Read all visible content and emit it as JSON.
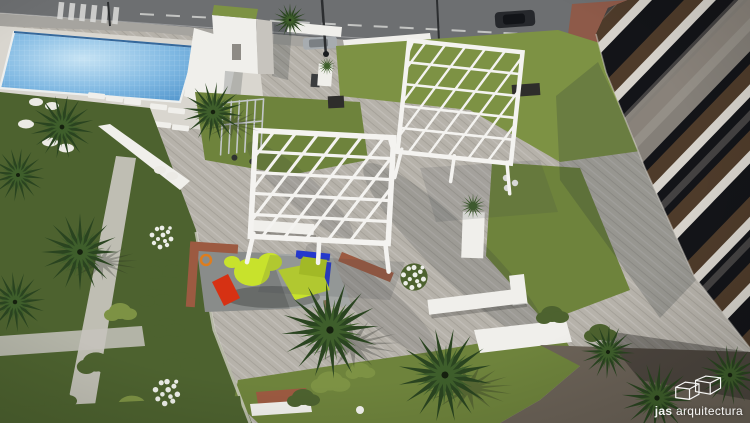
{
  "watermark": {
    "brand_bold": "jas",
    "brand_rest": " arquitectura",
    "logo_icon": "double-cube-wireframe-icon"
  },
  "palette": {
    "plaza_paving": "#b6b2aa",
    "street_asphalt": "#6d6f71",
    "sidewalk_grey": "#a6a49f",
    "structure_white": "#f0efeb",
    "deck_white": "#d9d6cf",
    "pergola_white": "#f4f3f0",
    "pool_light": "#c6e3f4",
    "pool_mid": "#7fb8e2",
    "pool_deep": "#4b90c9",
    "pool_edge": "#35689b",
    "lawn_green": "#6e833c",
    "lawn_bright": "#7d9244",
    "lawn_dark": "#4d622f",
    "palm_dark": "#2a4420",
    "palm_mid": "#3e5e2b",
    "brick_red": "#9c5a41",
    "building_slab": "#d6d2cb",
    "building_glass": "#131418",
    "building_wood": "#4e3b2a",
    "building_concrete": "#8e8981",
    "building_base": "#262019",
    "bike_lane_red": "#8e5a49",
    "play_surface": "#a4a7a5",
    "play_yellow": "#c8e22c",
    "play_blue": "#2438cd",
    "play_red": "#d63113",
    "play_orange": "#de7d1e",
    "ground_dark": "#6b6257",
    "watermark_white": "#ffffff"
  }
}
